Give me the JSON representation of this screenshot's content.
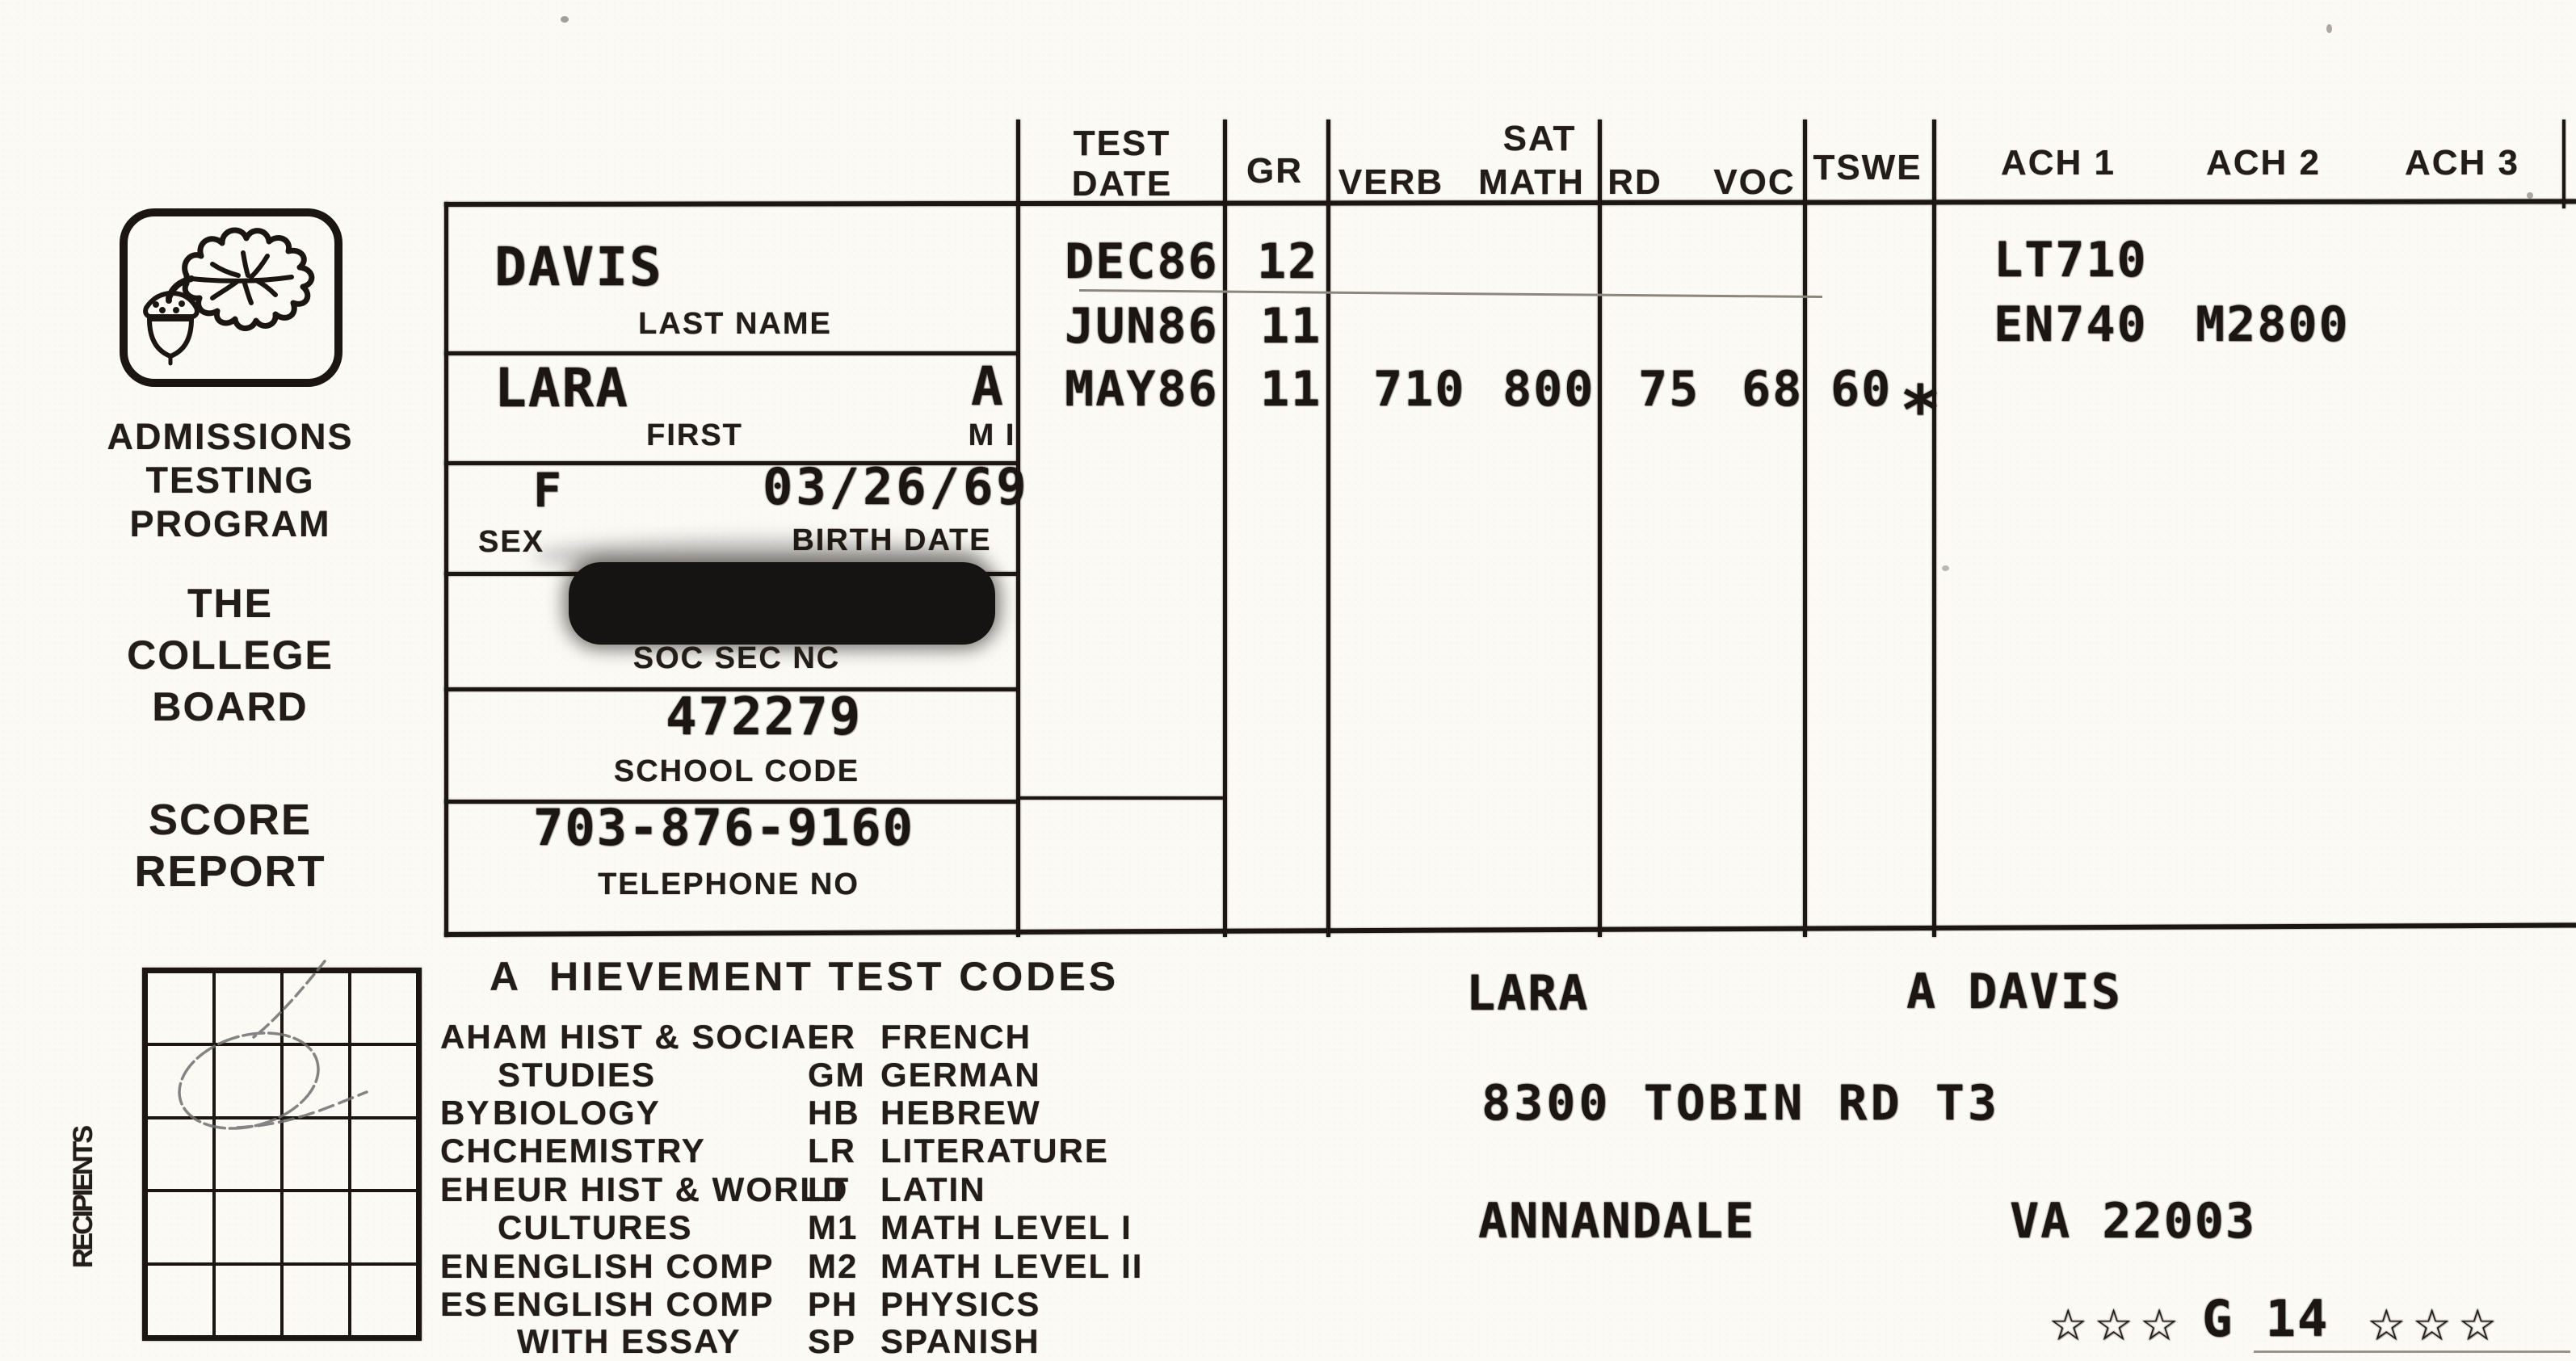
{
  "colors": {
    "ink": "#1b1611",
    "paper": "#fbfaf5",
    "pen_mark": "#707070"
  },
  "header": {
    "test": "TEST",
    "date": "DATE",
    "gr": "GR",
    "sat": "SAT",
    "verb": "VERB",
    "math": "MATH",
    "rd": "RD",
    "voc": "VOC",
    "tswe": "TSWE",
    "ach1": "ACH 1",
    "ach2": "ACH 2",
    "ach3": "ACH 3"
  },
  "branding": {
    "logo_icon": "oak-leaf-acorn",
    "program_line1": "ADMISSIONS",
    "program_line2": "TESTING",
    "program_line3": "PROGRAM",
    "org_line1": "THE",
    "org_line2": "COLLEGE",
    "org_line3": "BOARD",
    "report_line1": "SCORE",
    "report_line2": "REPORT"
  },
  "student": {
    "last_name": "DAVIS",
    "last_name_label": "LAST NAME",
    "first_name": "LARA",
    "first_label": "FIRST",
    "middle_initial": "A",
    "middle_initial_label": "M I",
    "sex": "F",
    "sex_label": "SEX",
    "birth_date": "03/26/69",
    "birth_date_label": "BIRTH DATE",
    "soc_sec_label": "SOC SEC NC",
    "school_code": "472279",
    "school_code_label": "SCHOOL CODE",
    "telephone": "703-876-9160",
    "telephone_label": "TELEPHONE NO"
  },
  "scores": {
    "rows": [
      {
        "date": "DEC86",
        "grade": "12",
        "verb": "",
        "math": "",
        "rd": "",
        "voc": "",
        "tswe": "",
        "tswe_star": "",
        "ach1": "LT710",
        "ach2": ""
      },
      {
        "date": "JUN86",
        "grade": "11",
        "verb": "",
        "math": "",
        "rd": "",
        "voc": "",
        "tswe": "",
        "tswe_star": "",
        "ach1": "EN740",
        "ach2": "M2800"
      },
      {
        "date": "MAY86",
        "grade": "11",
        "verb": "710",
        "math": "800",
        "rd": "75",
        "voc": "68",
        "tswe": "60",
        "tswe_star": "*",
        "ach1": "",
        "ach2": ""
      }
    ]
  },
  "recipients": {
    "label": "RECIPIENTS"
  },
  "codes": {
    "title": "A  HIEVEMENT TEST CODES",
    "left": [
      {
        "code": "AH",
        "name": "AM HIST & SOCIAL"
      },
      {
        "code": "",
        "name": "STUDIES"
      },
      {
        "code": "BY",
        "name": "BIOLOGY"
      },
      {
        "code": "CH",
        "name": "CHEMISTRY"
      },
      {
        "code": "EH",
        "name": "EUR HIST & WORLD"
      },
      {
        "code": "",
        "name": "CULTURES"
      },
      {
        "code": "EN",
        "name": "ENGLISH COMP"
      },
      {
        "code": "ES",
        "name": "ENGLISH COMP"
      },
      {
        "code": "",
        "name": "WITH ESSAY"
      }
    ],
    "right": [
      {
        "code": "FR",
        "name": "FRENCH"
      },
      {
        "code": "GM",
        "name": "GERMAN"
      },
      {
        "code": "HB",
        "name": "HEBREW"
      },
      {
        "code": "LR",
        "name": "LITERATURE"
      },
      {
        "code": "LT",
        "name": "LATIN"
      },
      {
        "code": "M1",
        "name": "MATH LEVEL I"
      },
      {
        "code": "M2",
        "name": "MATH LEVEL II"
      },
      {
        "code": "PH",
        "name": "PHYSICS"
      },
      {
        "code": "SP",
        "name": "SPANISH"
      }
    ]
  },
  "mailing": {
    "recipient_first": "LARA",
    "recipient_rest": "A DAVIS",
    "street": "8300 TOBIN RD T3",
    "city": "ANNANDALE",
    "state_zip": "VA 22003",
    "stars_left": "☆☆☆",
    "sort_code": "G 14",
    "stars_right": "☆☆☆"
  }
}
